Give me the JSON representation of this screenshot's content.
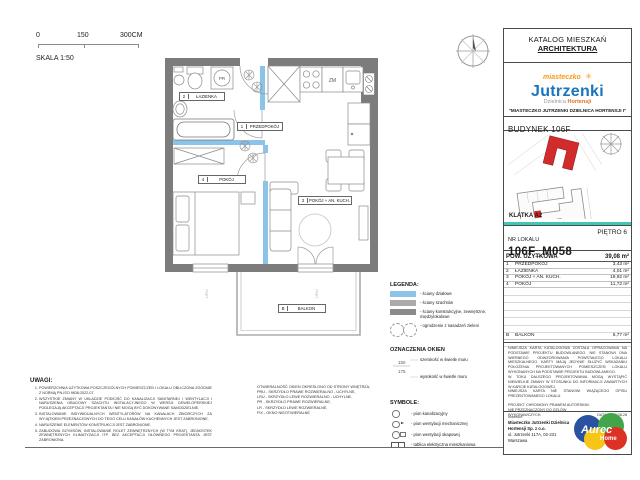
{
  "scale": {
    "ticks": [
      "0",
      "150",
      "300CM"
    ],
    "label": "SKALA 1:50"
  },
  "header": {
    "line1": "KATALOG MIESZKAŃ",
    "line2": "ARCHITEKTURA"
  },
  "brand": {
    "top": "miasteczko",
    "name": "Jutrzenki",
    "sun": "✳",
    "sub_prefix": "Dzielnica",
    "sub": "Hortensji",
    "quote": "\"MIASTECZKO JUTRZENKI DZIELNICA HORTENSJI I\""
  },
  "building": {
    "label": "BUDYNEK 106F",
    "klatka": "KLATKA A2"
  },
  "unit": {
    "nr_label": "NR LOKALU",
    "code": "106F_M058",
    "floor": "PIĘTRO 6"
  },
  "area_table": {
    "header_label": "POW. UŻYTKOWA",
    "header_value": "39,08 m²",
    "rows": [
      {
        "no": "1",
        "name": "PRZEDPOKÓJ",
        "value": "3,43 m²"
      },
      {
        "no": "2",
        "name": "ŁAZIENKA",
        "value": "4,01 m²"
      },
      {
        "no": "3",
        "name": "POKÓJ + AN. KUCH.",
        "value": "19,92 m²"
      },
      {
        "no": "4",
        "name": "POKÓJ",
        "value": "11,72 m²"
      }
    ],
    "balcony_row": {
      "no": "B",
      "name": "BALKON",
      "value": "6,77 m²"
    }
  },
  "plan": {
    "rooms": {
      "bathroom": {
        "no": "2",
        "name": "ŁAZIENKA"
      },
      "hall": {
        "no": "1",
        "name": "PRZEDPOKÓJ"
      },
      "bedroom": {
        "no": "4",
        "name": "POKÓJ"
      },
      "living": {
        "no": "3",
        "name": "POKÓJ + AN. KUCH."
      },
      "balcony": {
        "no": "B",
        "name": "BALKON"
      }
    },
    "appliances": {
      "washer": "PR",
      "dishwasher": "ZM"
    },
    "window_marks": [
      "URU",
      "URU"
    ]
  },
  "legend": {
    "title": "LEGENDA:",
    "items": [
      {
        "kind": "partition",
        "label": "- ściany działowe"
      },
      {
        "kind": "shaft",
        "label": "- ściany szachtów"
      },
      {
        "kind": "structural",
        "label": "- ściany konstrukcyjne, zewnętrzne, międzylokalowe"
      },
      {
        "kind": "fence",
        "label": "- ogrodzenie z nasadzeń zieleni"
      }
    ]
  },
  "window_markings": {
    "title": "OZNACZENIA OKIEN",
    "width_num": "150",
    "height_num": "175",
    "width_label": "szerokość w świetle muru",
    "height_label": "wysokość w świetle muru"
  },
  "window_note": [
    "OTWIERALNOŚĆ OKIEN OKREŚLONO OD STRONY WNĘTRZA,",
    "PRU - SKRZYDŁO PRAWE ROZWIERALNO - UCHYLNE,",
    "LRU - SKRZYDŁO LEWE ROZWIERALNO - UCHYLNE,",
    "PR - SKRZYDŁO PRAWE ROZWIERALNE,",
    "LR - SKRZYDŁO LEWE ROZWIERALNE,",
    "FIX - OKNO NIEOTWIERALNE"
  ],
  "symbols": {
    "title": "SYMBOLE:",
    "items": [
      {
        "kind": "sewage-riser",
        "label": "- pion kanalizacyjny"
      },
      {
        "kind": "mechanical-vent-riser",
        "label": "- pion wentylacji mechanicznej"
      },
      {
        "kind": "hood-vent-riser",
        "label": "- pion wentylacji okapowej"
      },
      {
        "kind": "electrical-panel",
        "label": "- tablica elektryczna mieszkaniowa"
      }
    ]
  },
  "uwagi": {
    "title": "UWAGI:",
    "items": [
      "POWIERZCHNIA UŻYTKOWA POSZCZEGÓLNYCH POMIESZCZEŃ I LOKALU OBLICZONA ZGODNIE Z NORMĄ PN-ISO 9836:2022-07.",
      "WSZYSTKIE ZMIANY W UKŁADZIE PODEJŚĆ DO KANALIZACJI SANITARNEJ I WENTYLACJI I NARUSZENIA OBUDOWY SZACHTU INSTALACYJNEGO W WERSJI DEWELOPERSKIEJ PODLEGAJĄ AKCEPTACJI PROJEKTANTA I NIE MOGĄ BYĆ DOKONYWANE SAMODZIELNIE.",
      "INSTALOWANIE INDYWIDUALNYCH WENTYLATORÓW NA KANAŁACH ZBIORCZYCH ZA WYJĄTKIEM PRZEZNACZONYCH DO TEGO CELU KANAŁÓW KUCHENNYCH JEST ZABRONIONE.",
      "NARUSZENIE ELEMENTÓW KONSTRUKCJI JEST ZABRONIONE.",
      "ZABUDOWA GZYMSÓW, INSTALOWANIE ROLET ZEWNĘTRZNYCH (W TYM KRAT), JEDNOSTEK ZEWNĘTRZNYCH KLIMATYZACJI ITP. BEZ AKCEPTACJI GŁÓWNEGO PROJEKTANTA JEST ZABRONIONA."
    ]
  },
  "disclaimer": {
    "paragraphs": [
      "NINIEJSZA KARTA KATALOGOWA ZOSTAŁA OPRACOWANA NA PODSTAWIE PROJEKTU BUDOWLANEGO. NIE STANOWI ONA WIERNEGO ODWZOROWANIA POWSTAŁEGO LOKALU MIESZKALNEGO. KARTY MAJĄ JEDYNIE SŁUŻYĆ WSKAZANIU POŁOŻENIA PROJEKTOWANYCH POMIESZCZEŃ LOKALU WYKONANYCH NA PODSTAWIE PROJEKTU BUDOWLANEGO.",
      "W TOKU DALSZEGO PROJEKTOWANIA MOGĄ WYSTĄPIĆ NIEWIELKIE ZMIANY W STOSUNKU DO INFORMACJI ZAWARTYCH W KARCIE KATALOGOWEJ.",
      "NINIEJSZA KARTA NIE STANOWI WIĄŻĄCEGO OPISU PREZENTOWANEGO LOKALU."
    ],
    "protect1": "PROJEKT CHRONIONY PRAWEM AUTORSKIM.",
    "protect2": "NIE PRZEZNACZONY DO CELÓW WYKONAWCZYCH.",
    "date": "DATA_2023.08.28"
  },
  "investor": {
    "label": "Inwestor:",
    "name": "Miasteczko Jutrzenki Dzielnica Hortensji Sp. z o.o.",
    "address": "ul. Jutrzenki 117A, 02-231 Warszawa"
  },
  "aurec": {
    "name": "Aurec",
    "sub": "Home"
  },
  "colors": {
    "wall": "#7c7c7c",
    "partition": "#8cc3e8",
    "teal": "#42c7b5",
    "marker_red": "#d22b2b",
    "brand_blue": "#1b75bc",
    "brand_orange": "#f49a1c"
  }
}
